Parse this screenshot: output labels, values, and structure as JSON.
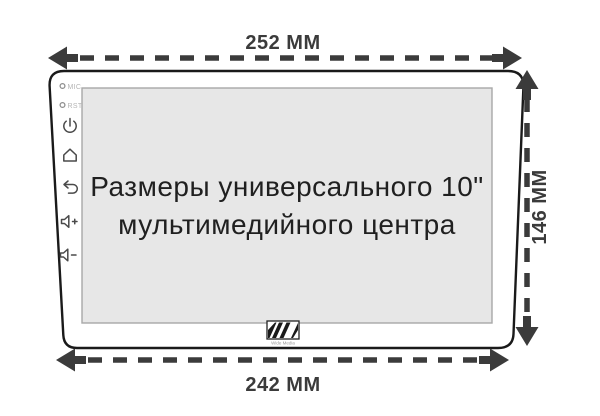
{
  "title": {
    "line1": "Размеры универсального 10\"",
    "line2": "мультимедийного центра"
  },
  "dimensions": {
    "top_width": "252 ММ",
    "bottom_width": "242 ММ",
    "height": "146 ММ"
  },
  "device": {
    "type": "universal 10-inch car multimedia head unit outline",
    "mic_label": "MIC",
    "rst_label": "RST",
    "logo_text": "Wide Media",
    "side_buttons": [
      "power",
      "home",
      "back",
      "volume-up",
      "volume-down"
    ]
  },
  "colors": {
    "dimension_arrows": "#3b3b3b",
    "device_outline": "#1a1a1a",
    "screen_fill": "#e7e7e7",
    "screen_border": "#a8a8a8",
    "faint_port_label": "#b5b5b5",
    "icon_stroke": "#4a4a4a",
    "background": "#ffffff"
  }
}
